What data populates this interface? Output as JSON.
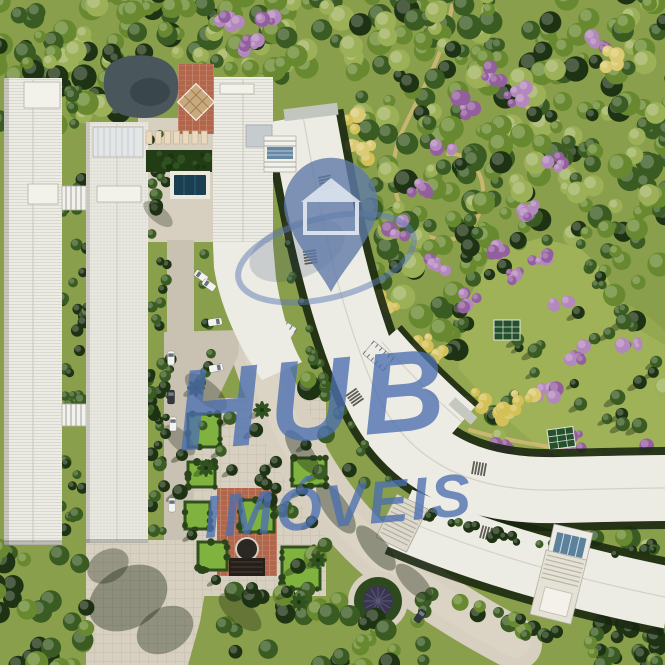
{
  "meta": {
    "type": "aerial-architectural-render",
    "subject": "condominium masterplan seen from above with forest park, curved residential slabs, linear buildings, gardens and internal roads"
  },
  "watermark": {
    "brand_line1": "HUB",
    "brand_line2": "IMÓVEIS",
    "icon": "map-pin-house-icon"
  },
  "palette": {
    "grass": "#8a9f4b",
    "grassLight": "#9fb258",
    "lawn": "#7fb23e",
    "hedge": "#30511e",
    "treeDark": "#1d3313",
    "treeMid": "#3a5b22",
    "treeLight": "#68892f",
    "treePale": "#9cb058",
    "treeYellow": "#d3c158",
    "treePink": "#b388bc",
    "treePinkDeep": "#935f9e",
    "roof": "#edece4",
    "roofShade": "#d9d7cb",
    "pavement": "#d7d0c0",
    "road": "#c9c2b2",
    "terracotta": "#b2674c",
    "pool": "#1c3e51",
    "pond": "#49565c",
    "glass": "#4d7596",
    "shadow": "#1f2a14",
    "carLight": "#f2f2ef",
    "carDark": "#32383e",
    "wmPin": "#5f7aa8",
    "wmText": "#4c6fb0",
    "wmRing": "#5d7cb4"
  }
}
